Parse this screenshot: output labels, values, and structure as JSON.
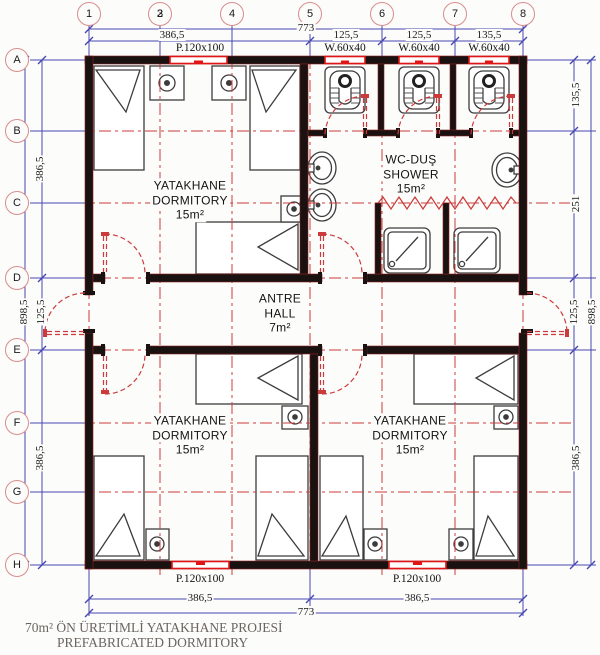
{
  "title_block": {
    "line1": "70m² ÖN ÜRETİMLİ YATAKHANE PROJESİ",
    "line2": "PREFABRICATED DORMITORY"
  },
  "grid": {
    "columns": [
      "1",
      "2",
      "3",
      "4",
      "5",
      "6",
      "7",
      "8"
    ],
    "rows": [
      "A",
      "B",
      "C",
      "D",
      "E",
      "F",
      "G",
      "H"
    ]
  },
  "rooms": {
    "dorm_top_left": {
      "line1": "YATAKHANE",
      "line2": "DORMITORY",
      "area": "15m²"
    },
    "wc_shower": {
      "line1": "WC-DUŞ",
      "line2": "SHOWER",
      "area": "15m²"
    },
    "hall": {
      "line1": "ANTRE",
      "line2": "HALL",
      "area": "7m²"
    },
    "dorm_bottom_left": {
      "line1": "YATAKHANE",
      "line2": "DORMITORY",
      "area": "15m²"
    },
    "dorm_bottom_right": {
      "line1": "YATAKHANE",
      "line2": "DORMITORY",
      "area": "15m²"
    }
  },
  "dims": {
    "top_total": "773",
    "top_segments": [
      "386,5",
      "125,5",
      "125,5",
      "135,5"
    ],
    "bottom_segments": [
      "386,5",
      "386,5"
    ],
    "bottom_total": "773",
    "left": {
      "a_d": "386,5",
      "total": "898,5",
      "d_e": "125,5",
      "e_h": "386,5"
    },
    "right": {
      "a_b": "135,5",
      "b_d": "251",
      "d_e": "125,5",
      "total": "898,5",
      "e_h": "386,5"
    }
  },
  "openings": {
    "window_top": "P.120x100",
    "wc_windows": [
      "W.60x40",
      "W.60x40",
      "W.60x40"
    ],
    "windows_bottom": [
      "P.120x100",
      "P.120x100"
    ]
  },
  "colors": {
    "dimension_blue": "#4747b3",
    "centerline_red": "#cc3b3b",
    "window_red": "#e01616",
    "wall": "#191210",
    "bubble_ring": "#d98c8c",
    "title_text": "#6b655f"
  }
}
